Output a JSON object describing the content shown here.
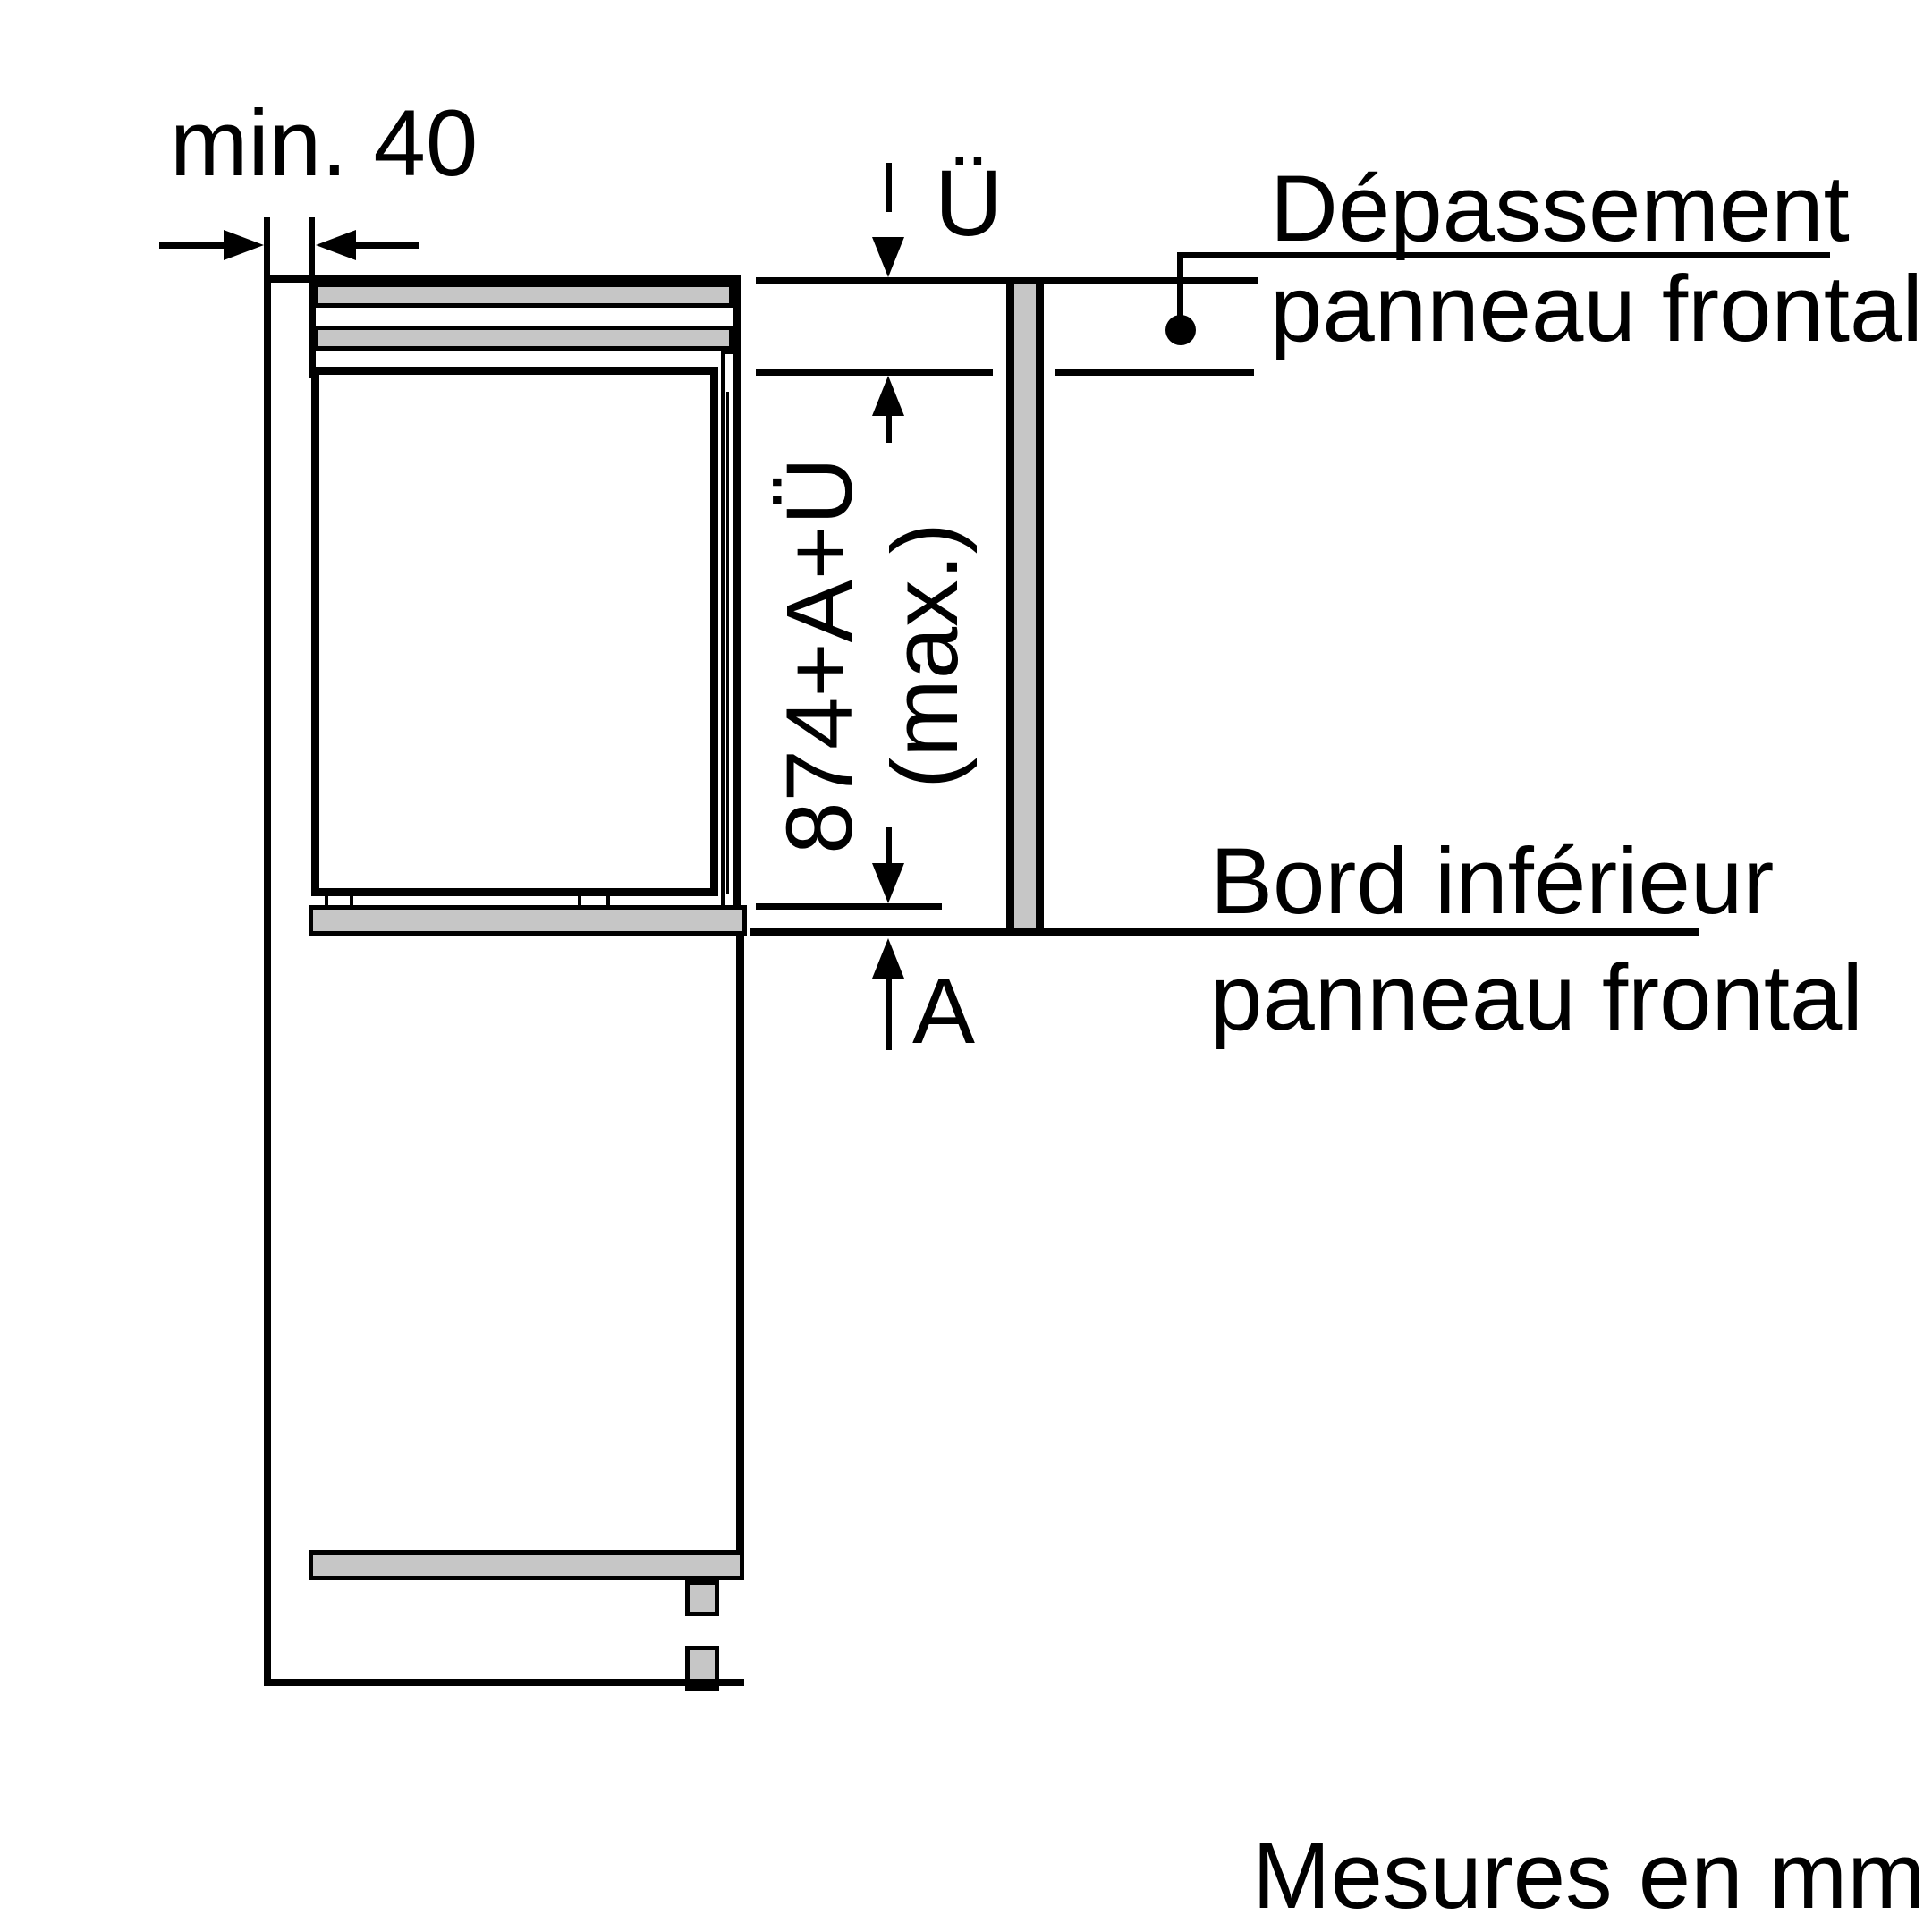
{
  "diagram": {
    "type": "built-in fridge installation side-section drawing",
    "labels": {
      "min_clearance": "min. 40",
      "overhang_symbol": "Ü",
      "overhang_label_line1": "Dépassement",
      "overhang_label_line2": "panneau frontal",
      "height_formula_line1": "874+A+Ü",
      "height_formula_line2": "(max.)",
      "bottom_offset_symbol": "A",
      "lower_edge_label_line1": "Bord inférieur",
      "lower_edge_label_line2": "panneau frontal",
      "units_note": "Mesures en mm"
    },
    "colors": {
      "line": "#000000",
      "panel_fill": "#c6c6c6",
      "background": "#ffffff"
    }
  }
}
